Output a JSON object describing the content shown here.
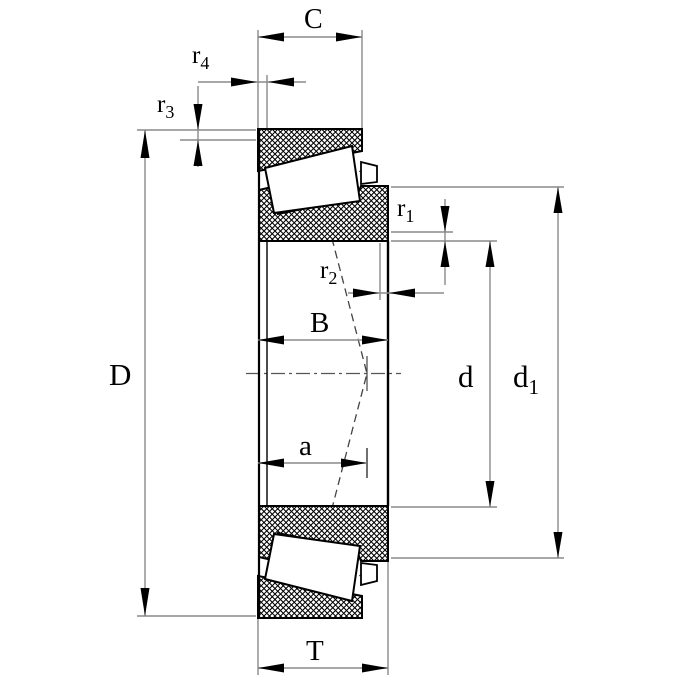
{
  "drawing": {
    "description": "tapered-roller-bearing-cross-section-dimension-drawing",
    "labels": {
      "C": "C",
      "r4": {
        "base": "r",
        "sub": "4"
      },
      "r3": {
        "base": "r",
        "sub": "3"
      },
      "r1": {
        "base": "r",
        "sub": "1"
      },
      "r2": {
        "base": "r",
        "sub": "2"
      },
      "B": "B",
      "D": "D",
      "a": "a",
      "d": "d",
      "d1": {
        "base": "d",
        "sub": "1"
      },
      "T": "T"
    },
    "colors": {
      "outline": "#000000",
      "dimension_line": "#8a8a8a",
      "background": "#ffffff"
    }
  }
}
